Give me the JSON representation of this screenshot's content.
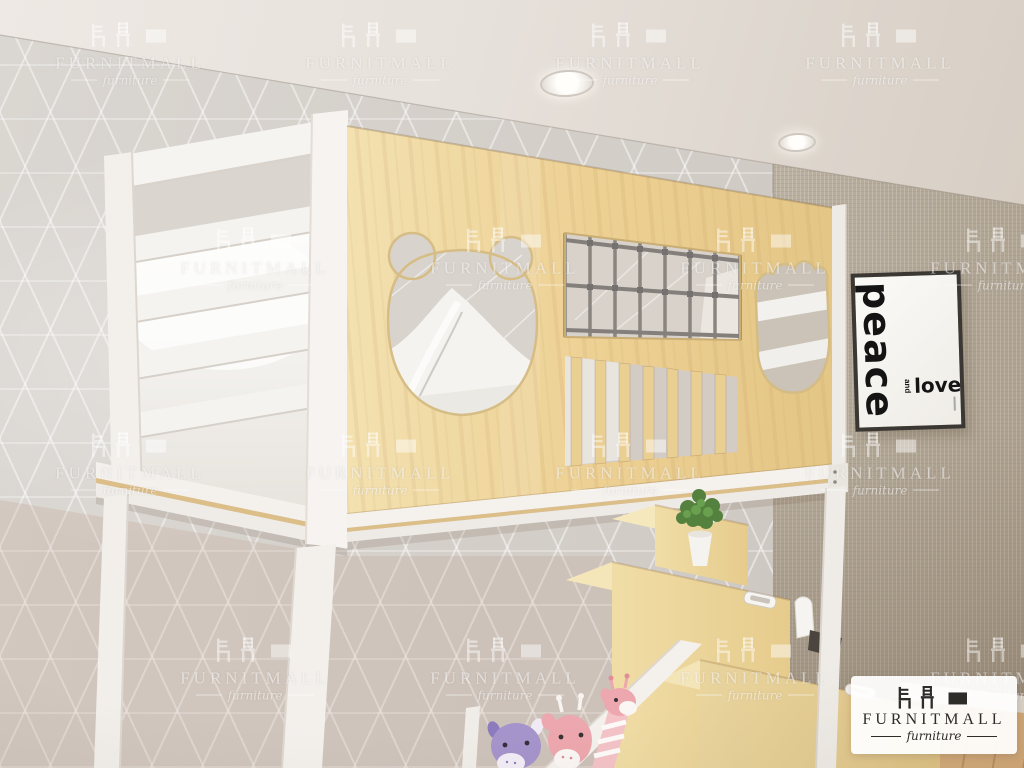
{
  "poster": {
    "vertical_word": "peace",
    "connector_word": "and",
    "horizontal_word": "love"
  },
  "brand_badge": {
    "name": "FURNITMALL",
    "tagline": "furniture"
  },
  "watermark": {
    "name": "FURNITMALL",
    "tagline": "furniture"
  },
  "room": {
    "colors": {
      "ceiling": "#e9e4df",
      "wall_left_tile": "#d5d1cc",
      "wall_right_linen": "#ccc4b7",
      "bed_wood": "#ecd69d",
      "bed_frame_white": "#f4f1ed",
      "net_rope": "#8b8580",
      "poster_text": "#141414",
      "badge_text": "#2e2c29",
      "floor_wood": "#d9b283"
    }
  }
}
